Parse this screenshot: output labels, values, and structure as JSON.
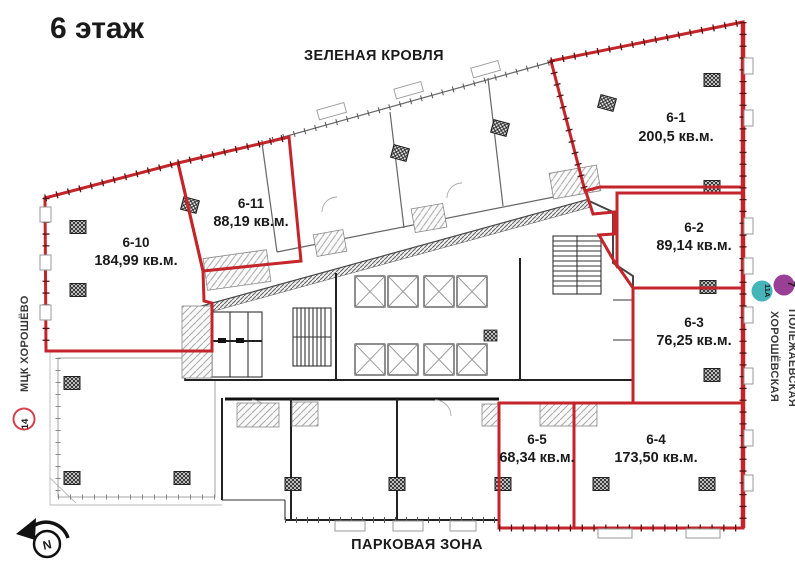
{
  "title": "6 этаж",
  "zones": {
    "top": "ЗЕЛЕНАЯ КРОВЛЯ",
    "bottom": "ПАРКОВАЯ ЗОНА"
  },
  "units": [
    {
      "number": "6-1",
      "area": "200,5 кв.м."
    },
    {
      "number": "6-2",
      "area": "89,14 кв.м."
    },
    {
      "number": "6-3",
      "area": "76,25 кв.м."
    },
    {
      "number": "6-4",
      "area": "173,50 кв.м."
    },
    {
      "number": "6-5",
      "area": "68,34 кв.м."
    },
    {
      "number": "6-10",
      "area": "184,99 кв.м."
    },
    {
      "number": "6-11",
      "area": "88,19 кв.м."
    }
  ],
  "transit_left": {
    "badge": "14",
    "station": "МЦК ХОРОШЁВО",
    "color": "#d6404d"
  },
  "transit_right": {
    "badges": [
      {
        "label": "11А",
        "color": "#46b5ba"
      },
      {
        "label": "7",
        "color": "#9a3f96"
      }
    ],
    "stations": [
      "ПОЛЕЖАЕВСКАЯ",
      "ХОРОШЁВСКАЯ"
    ]
  },
  "compass": {
    "label": "N"
  },
  "colors": {
    "unit_outline": "#c4252b",
    "walls": "#333333"
  }
}
